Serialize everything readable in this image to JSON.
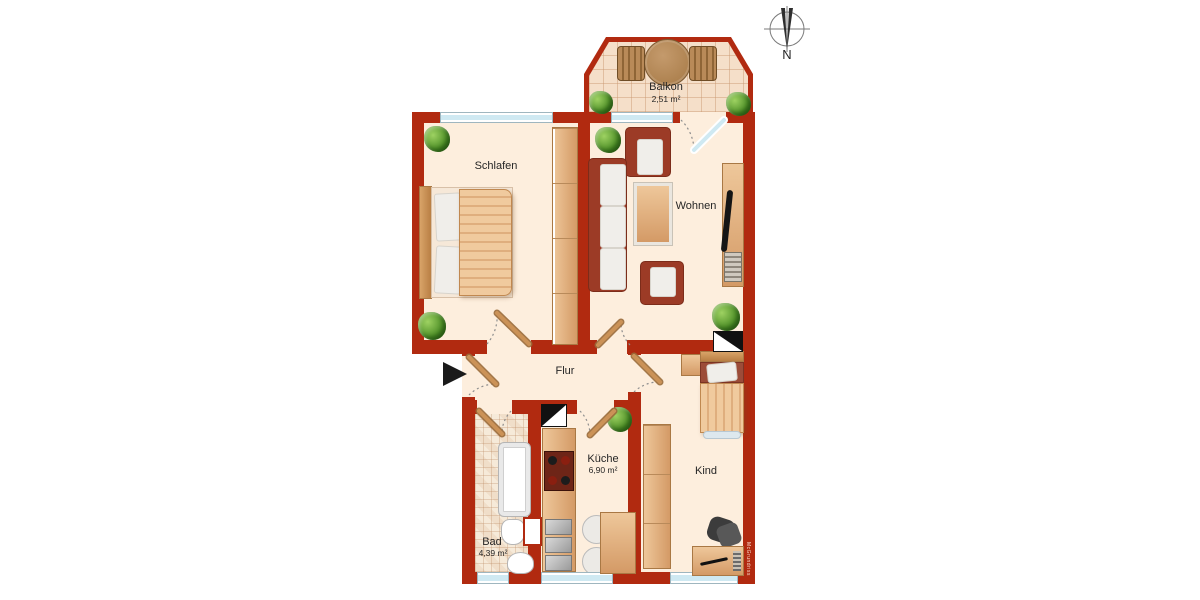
{
  "rooms": {
    "balkon": {
      "name": "Balkon",
      "area": "2,51 m²"
    },
    "schlafen": {
      "name": "Schlafen"
    },
    "wohnen": {
      "name": "Wohnen"
    },
    "flur": {
      "name": "Flur"
    },
    "kueche": {
      "name": "Küche",
      "area": "6,90 m²"
    },
    "bad": {
      "name": "Bad",
      "area": "4,39 m²"
    },
    "kind": {
      "name": "Kind"
    }
  },
  "compass": {
    "north_label": "N"
  },
  "watermark": "McGrundriss",
  "icons": {
    "compass": "compass-rose-circle",
    "entrance": "right-arrow-triangle",
    "shaft": "half-filled-square",
    "plant": "potted-plant"
  },
  "colors": {
    "wall": "#b12a10",
    "floor": "#fdeedd",
    "balcony_tile": "#f5dfc9",
    "wood": "#dda873",
    "upholstery": "#9c3b26",
    "window_glass": "#cfe9f2",
    "plant": "#4e8f27"
  }
}
